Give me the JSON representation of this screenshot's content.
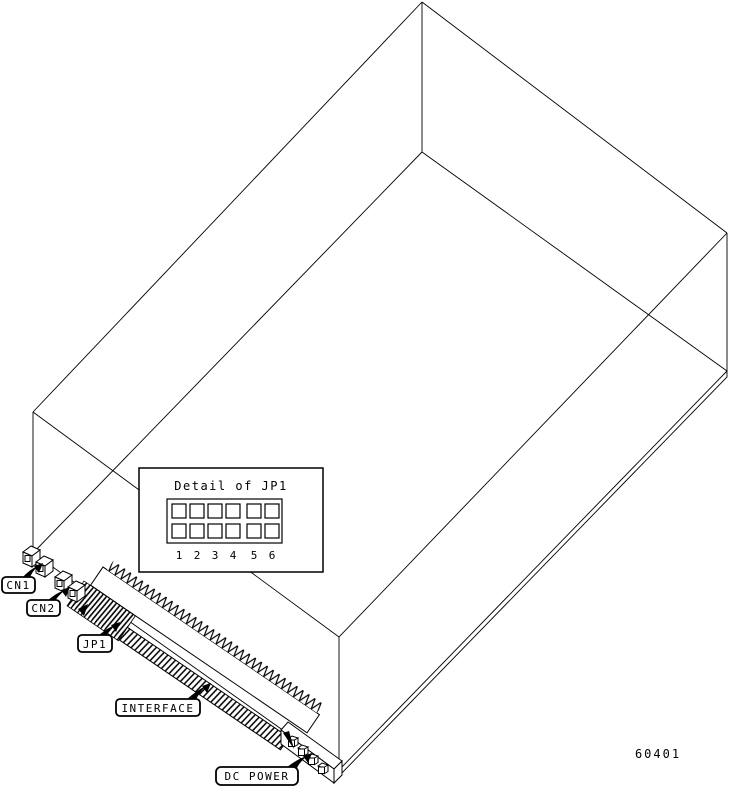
{
  "figure": {
    "type": "hardware-connector-diagram",
    "part_number": "60401",
    "inset": {
      "title": "Detail of JP1",
      "rows": 2,
      "columns": 6,
      "pin_labels": [
        "1",
        "2",
        "3",
        "4",
        "5",
        "6"
      ]
    },
    "callouts": {
      "cn1": "CN1",
      "cn2": "CN2",
      "jp1": "JP1",
      "interface": "INTERFACE",
      "dc_power": "DC POWER"
    }
  }
}
